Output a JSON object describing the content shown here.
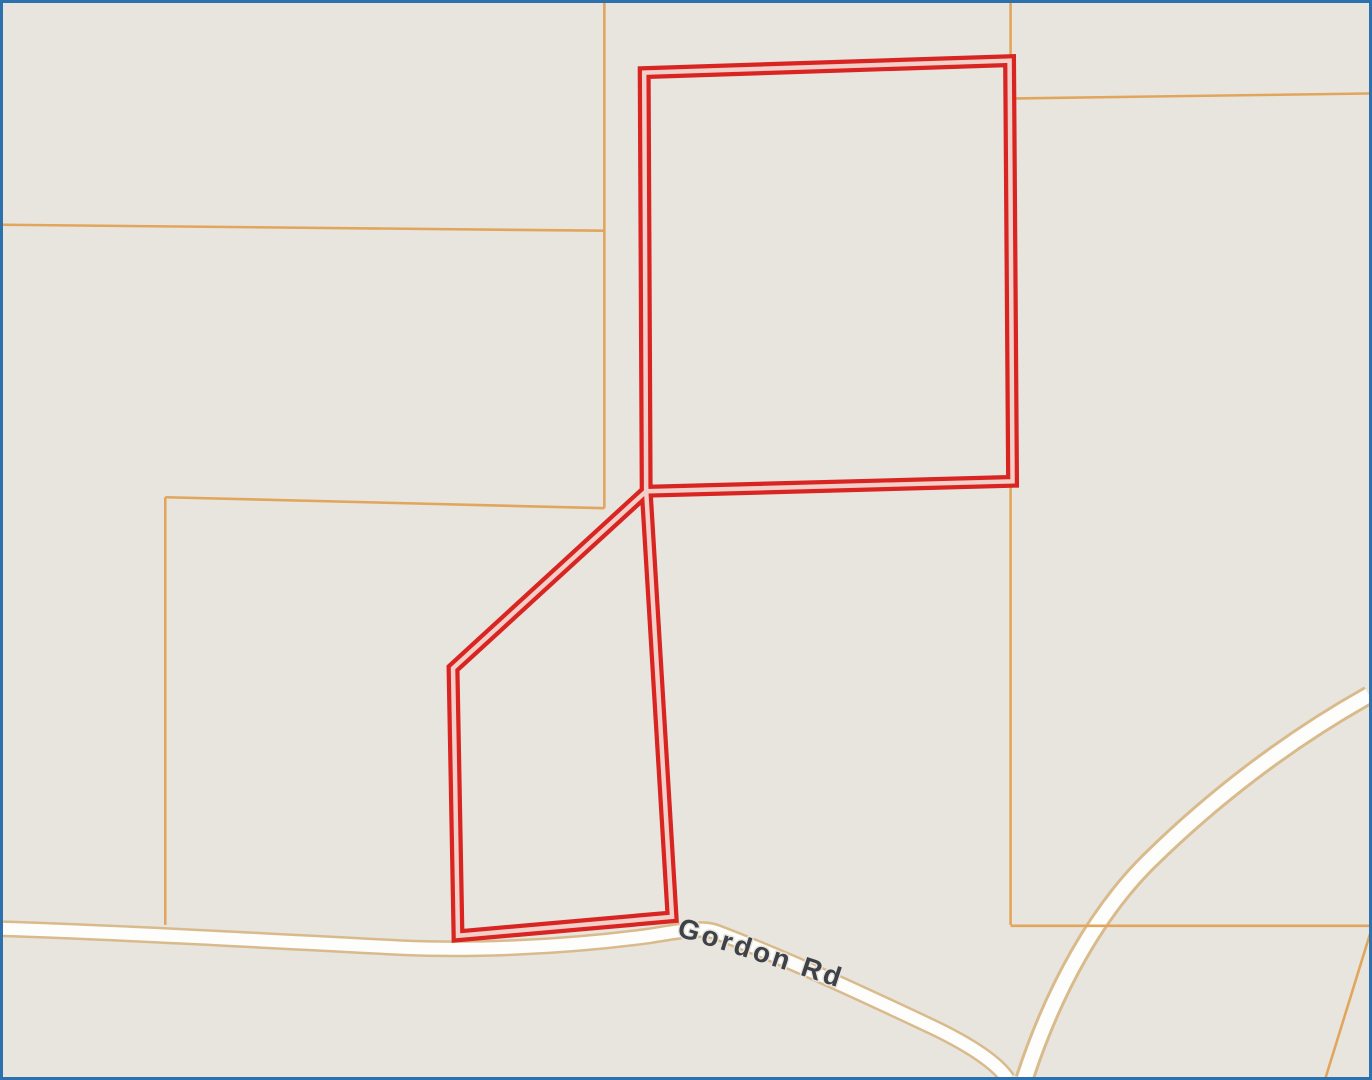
{
  "map": {
    "road_label": "Gordon Rd",
    "label_path": "M676,938 C740,957 800,977 866,999",
    "colors": {
      "background": "#e8e5df",
      "frame": "#2c71ad",
      "parcel_line": "#e2a55c",
      "road_casing": "#d9ba8b",
      "road_fill": "#fdfdfc",
      "selection_outer": "#d92522",
      "selection_inner": "#f3cfc9",
      "label_text": "#3e4147",
      "label_halo": "#e8e5df"
    },
    "stroke_widths": {
      "parcel_line": 2.6,
      "selection_outer": 13,
      "selection_inner": 4.5
    },
    "roads": [
      {
        "name": "gordon-rd",
        "path": "M0,931 C100,934 250,942 400,950 C470,953 560,950 650,938 C680,933 702,929 716,934 C790,962 862,996 932,1029 C976,1050 1000,1068 1009,1082",
        "casing_width": 17,
        "fill_width": 12
      },
      {
        "name": "branch-road",
        "path": "M1372,696 C1290,742 1215,800 1152,862 C1100,913 1056,990 1026,1082",
        "casing_width": 20,
        "fill_width": 14
      }
    ],
    "parcel_lines": [
      {
        "name": "parcel-line-west-upper",
        "path": "M0,223 L604,229"
      },
      {
        "name": "parcel-line-center-vertical",
        "path": "M604,0 L604,508"
      },
      {
        "name": "parcel-line-mid-horizontal",
        "path": "M604,508 L163,497"
      },
      {
        "name": "parcel-line-west-vertical",
        "path": "M163,497 L163,927"
      },
      {
        "name": "parcel-line-east-vertical",
        "path": "M1012,0 L1012,927"
      },
      {
        "name": "parcel-line-ne-horizontal",
        "path": "M1013,96 L1372,91"
      },
      {
        "name": "parcel-line-se-horizontal",
        "path": "M1012,928 L1372,928"
      },
      {
        "name": "parcel-line-se-diagonal",
        "path": "M1374,933 L1328,1082"
      }
    ],
    "selected_parcels": [
      {
        "name": "selected-parcel-north",
        "path": "M644,70 L1011,58 L1014,481 L646,491 Z"
      },
      {
        "name": "selected-parcel-south",
        "path": "M646,491 L672,919 L457,938 L452,669 Z"
      }
    ]
  }
}
